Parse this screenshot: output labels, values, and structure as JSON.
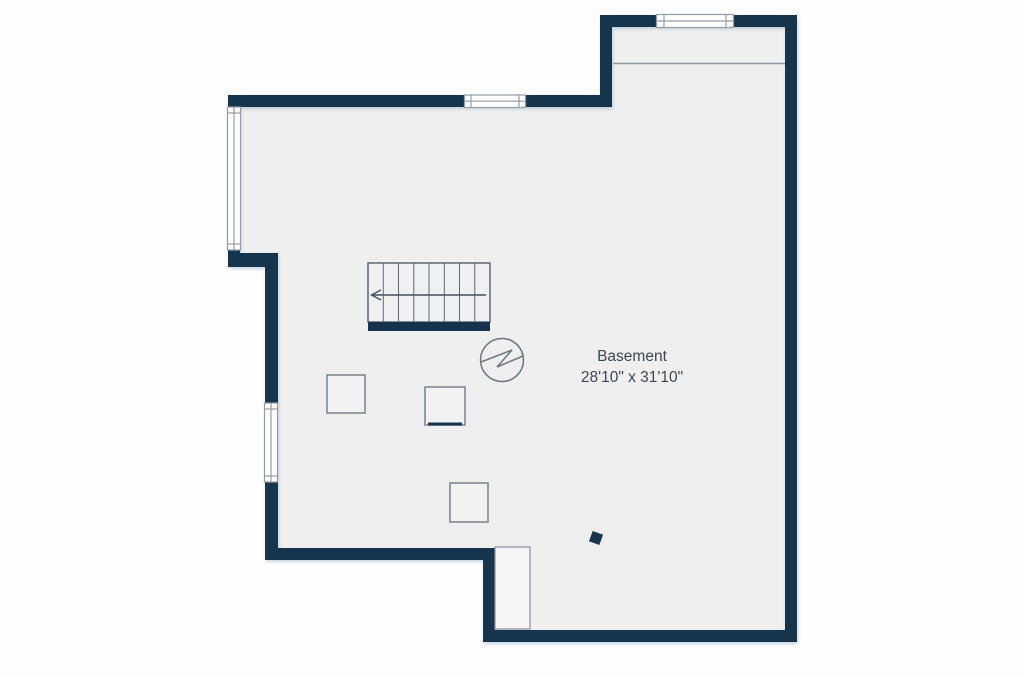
{
  "room": {
    "label": "Basement",
    "dimensions": "28'10\" x 31'10\""
  },
  "colors": {
    "wall": "#16344d",
    "floor": "#efefef",
    "background": "#ffffff",
    "window_fill": "#ffffff",
    "window_stroke": "#959ba3",
    "fixture_stroke": "#6f7680",
    "label_text": "#3d4752"
  },
  "features": [
    {
      "name": "staircase",
      "treads": 8,
      "direction_arrow": "left"
    },
    {
      "name": "water-heater-circle-icon"
    },
    {
      "name": "utility-square-1"
    },
    {
      "name": "utility-square-2"
    },
    {
      "name": "utility-square-3"
    },
    {
      "name": "stair-landing"
    },
    {
      "name": "support-post"
    },
    {
      "name": "window-bumpout-top"
    },
    {
      "name": "window-main-top"
    },
    {
      "name": "window-left-upper"
    },
    {
      "name": "window-left-lower"
    },
    {
      "name": "ceiling-change-line"
    }
  ]
}
